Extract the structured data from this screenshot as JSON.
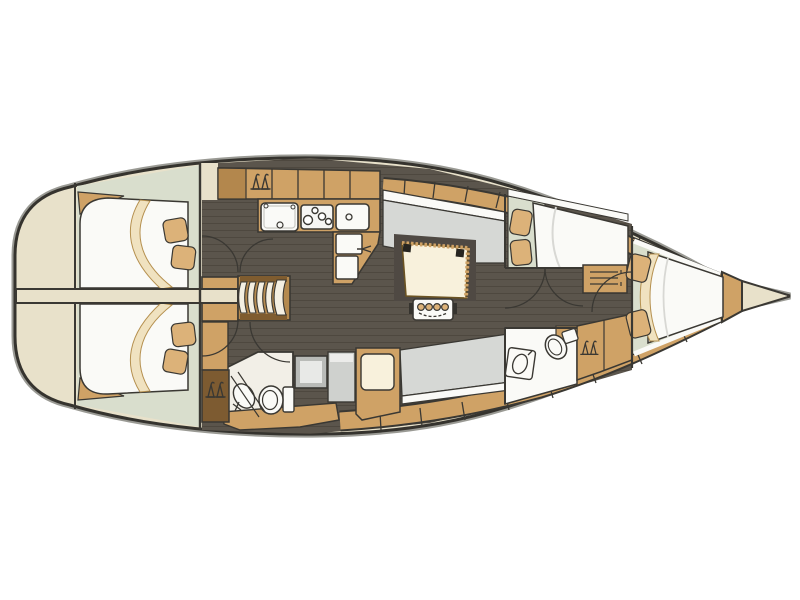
{
  "diagram": {
    "title": "Sailing yacht interior layout plan, top view, bow to the right",
    "orientation": {
      "bow": "right",
      "stern": "left"
    },
    "regions": [
      {
        "name": "swim-platform",
        "position": "stern far left"
      },
      {
        "name": "aft-cabin-port",
        "position": "stern top",
        "fixtures": [
          "double-berth",
          "mattress-edge-band",
          "pillow",
          "pillow"
        ]
      },
      {
        "name": "aft-cabin-starboard",
        "position": "stern bottom",
        "fixtures": [
          "double-berth",
          "mattress-edge-band",
          "pillow",
          "pillow"
        ]
      },
      {
        "name": "stern-walkway",
        "position": "centerline stern",
        "fixtures": [
          "walkway-plank"
        ]
      },
      {
        "name": "companionway",
        "position": "center-left",
        "fixtures": [
          "steps-5-treads",
          "wardrobe-hanging-locker"
        ]
      },
      {
        "name": "galley",
        "position": "top center",
        "fixtures": [
          "locker-row",
          "hanging-locker",
          "double-sink",
          "stove-4-burners",
          "single-sink",
          "fridge-lids-2",
          "worktop"
        ]
      },
      {
        "name": "aft-head",
        "position": "bottom center-left",
        "fixtures": [
          "toilet",
          "washbasin",
          "shower-screen",
          "shower-pan",
          "wardrobe-hanging-locker",
          "counter"
        ]
      },
      {
        "name": "saloon",
        "position": "center",
        "fixtures": [
          "dinette-table",
          "table-support-bracket",
          "u-settee-starboard",
          "straight-settee-port",
          "nav-seat",
          "side-cabinet"
        ]
      },
      {
        "name": "guest-cabin",
        "position": "forward top",
        "fixtures": [
          "double-berth",
          "pillow",
          "pillow",
          "drawer-unit",
          "shelf"
        ]
      },
      {
        "name": "fwd-head",
        "position": "forward bottom",
        "fixtures": [
          "toilet",
          "washbasin",
          "wardrobe-hanging-locker",
          "cabinet"
        ]
      },
      {
        "name": "corridor",
        "position": "forward centerline",
        "fixtures": [
          "door-guest-cabin",
          "door-fwd-head",
          "door-fwd-cabin"
        ]
      },
      {
        "name": "forward-cabin",
        "position": "bow",
        "fixtures": [
          "island-double-berth",
          "mattress-edge-band",
          "pillow",
          "pillow",
          "shelves"
        ]
      },
      {
        "name": "anchor-locker",
        "position": "bow tip"
      }
    ],
    "counts": {
      "cabins": 4,
      "heads": 2,
      "companionway_steps": 5,
      "stove_burners": 4,
      "galley_sinks": 3,
      "table_support_holes": 4,
      "door_swings": 7,
      "hanging_locker_icons": 4
    }
  },
  "palette": {
    "page_bg": "#ffffff",
    "deck_cream": "#e8e1ca",
    "hull_outline": "#35332e",
    "hull_halo": "#9a9a94",
    "line_dark": "#3a3833",
    "wood_tan": "#cfa266",
    "wood_tan_dark": "#b3874d",
    "wood_brown": "#7d5b31",
    "ladder_cap_brown": "#7f5c2f",
    "floor_dark": "#5b554c",
    "floor_plank_line": "#4e483f",
    "upholstery_gray": "#d6d8d5",
    "panel_gray": "#cfd1ce",
    "cabin_floor_green": "#d9decd",
    "berth_white": "#fafaf7",
    "mattress_cream": "#f0e2c0",
    "cushion_tan": "#dcb279",
    "table_cream": "#f8f1dc",
    "shower_pan_gray": "#b9bbb8"
  }
}
